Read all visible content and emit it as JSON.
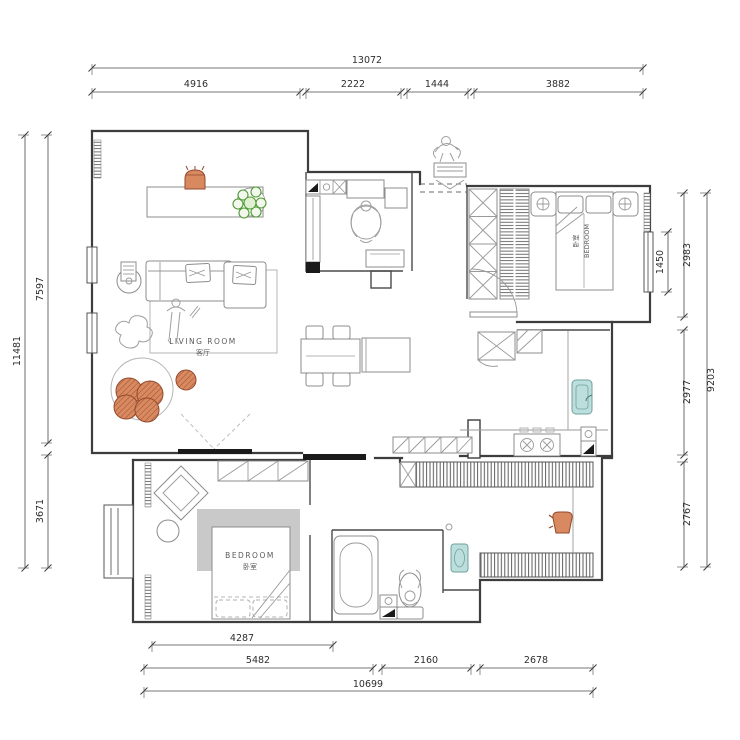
{
  "drawing_type": "apartment-floor-plan",
  "dimensions": {
    "top": {
      "total": "13072",
      "segments": [
        "4916",
        "2222",
        "1444",
        "3882"
      ]
    },
    "bottom": {
      "total": "10699",
      "segments": [
        "5482",
        "2160",
        "2678"
      ],
      "inner": "4287"
    },
    "left": {
      "total": "11481",
      "segments": [
        "7597",
        "3671"
      ]
    },
    "right": {
      "total": "9203",
      "segments": [
        "2983",
        "2977",
        "2767"
      ],
      "inner": "1450"
    }
  },
  "rooms": {
    "living_room": {
      "en": "LIVING ROOM",
      "zh": "客厅"
    },
    "bedroom_right": {
      "en": "BEDROOM",
      "zh": "卧室"
    },
    "bedroom_left": {
      "en": "BEDROOM",
      "zh": "卧室"
    }
  },
  "furniture_icons": [
    "sofa",
    "sideboard",
    "vase",
    "plant",
    "floor-lamp",
    "round-rug",
    "poufs",
    "tv",
    "dining-table",
    "kitchen-island",
    "refrigerator",
    "kitchen-sink",
    "stove",
    "double-bed",
    "nightstand",
    "wardrobe",
    "closet",
    "bathtub",
    "toilet",
    "washbasin",
    "balcony-railing",
    "entry-mat",
    "person-figure",
    "dog-figure"
  ],
  "colors": {
    "wall_dark": "#3d3d3d",
    "accent_orange": "#d8895f",
    "plant_green": "#4e9a34",
    "fixture_teal": "#bcdedd",
    "rug_gray": "#c9c9c9",
    "black_fill": "#1a1a1a"
  }
}
